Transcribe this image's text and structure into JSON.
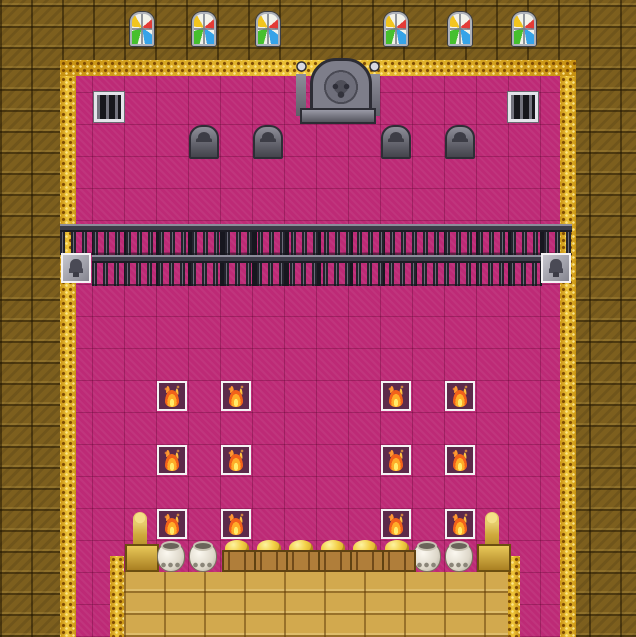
{
  "app": {
    "name": "rpg-map-throne-room",
    "visible_text": []
  },
  "palette": {
    "pink": "#bd2a76",
    "wall": "#7d5f1e",
    "gold": "#e2ae1f",
    "goldfloor": "#d2a94e",
    "white": "#f4f2f4",
    "firedark": "#5c2a4a"
  },
  "map": {
    "tile_size": 32,
    "canvas": {
      "w": 636,
      "h": 637
    },
    "legend": {
      "guard": "silver-helmet guard sprite in white event box",
      "fire": "brazier flame event tile on dark square",
      "sel": "event box highlighted with black border"
    },
    "regions": [
      {
        "t": "room",
        "n": "throne-room-carpet",
        "x": 60,
        "y": 60,
        "w": 516,
        "h": 577,
        "i": false
      },
      {
        "t": "trim",
        "n": "gold-lace-trim-top",
        "x": 60,
        "y": 60,
        "w": 516,
        "h": 16,
        "i": false
      },
      {
        "t": "trim",
        "n": "gold-lace-trim-left",
        "x": 60,
        "y": 76,
        "w": 16,
        "h": 561,
        "i": false
      },
      {
        "t": "trim",
        "n": "gold-lace-trim-right",
        "x": 560,
        "y": 76,
        "w": 16,
        "h": 561,
        "i": false
      },
      {
        "t": "trim",
        "n": "gold-lace-trim-dais-left",
        "x": 110,
        "y": 556,
        "w": 14,
        "h": 81,
        "i": false
      },
      {
        "t": "trim",
        "n": "gold-lace-trim-dais-right",
        "x": 506,
        "y": 556,
        "w": 14,
        "h": 81,
        "i": false
      },
      {
        "t": "goldfloor",
        "n": "gold-brick-dais",
        "x": 124,
        "y": 572,
        "w": 384,
        "h": 65,
        "i": false
      },
      {
        "t": "fence",
        "n": "fence-rail-upper",
        "x": 60,
        "y": 224,
        "w": 512,
        "h": 31,
        "i": false
      },
      {
        "t": "fence",
        "n": "fence-rail-lower",
        "x": 92,
        "y": 255,
        "w": 450,
        "h": 31,
        "i": false
      }
    ],
    "objects": [
      {
        "t": "sgwindow",
        "n": "stained-glass-window",
        "x": 130,
        "y": 12,
        "i": false
      },
      {
        "t": "sgwindow",
        "n": "stained-glass-window",
        "x": 192,
        "y": 12,
        "i": false
      },
      {
        "t": "sgwindow",
        "n": "stained-glass-window",
        "x": 256,
        "y": 12,
        "i": false
      },
      {
        "t": "sgwindow",
        "n": "stained-glass-window",
        "x": 384,
        "y": 12,
        "i": false
      },
      {
        "t": "sgwindow",
        "n": "stained-glass-window",
        "x": 448,
        "y": 12,
        "i": false
      },
      {
        "t": "sgwindow",
        "n": "stained-glass-window",
        "x": 512,
        "y": 12,
        "i": false
      },
      {
        "t": "vent",
        "n": "barred-vent-window",
        "x": 94,
        "y": 92,
        "i": false
      },
      {
        "t": "vent",
        "n": "barred-vent-window",
        "x": 508,
        "y": 92,
        "i": false
      },
      {
        "t": "throne",
        "n": "skull-throne",
        "x": 296,
        "y": 58,
        "i": false
      },
      {
        "t": "tombstone",
        "n": "tombstone",
        "x": 189,
        "y": 125,
        "i": false
      },
      {
        "t": "tombstone",
        "n": "tombstone",
        "x": 253,
        "y": 125,
        "i": false
      },
      {
        "t": "tombstone",
        "n": "tombstone",
        "x": 381,
        "y": 125,
        "i": false
      },
      {
        "t": "tombstone",
        "n": "tombstone",
        "x": 445,
        "y": 125,
        "i": false
      },
      {
        "t": "emblem",
        "n": "crest-emblem",
        "x": 61,
        "y": 253,
        "i": true
      },
      {
        "t": "emblem",
        "n": "crest-emblem",
        "x": 541,
        "y": 253,
        "i": true
      },
      {
        "t": "ent-king",
        "k": "char",
        "n": "king-sprite",
        "x": 189,
        "y": 157,
        "i": true
      },
      {
        "t": "ent-darkknight",
        "k": "char",
        "n": "dark-knight-sprite",
        "x": 253,
        "y": 157,
        "i": true
      },
      {
        "t": "ent-priestess",
        "k": "char",
        "n": "priestess-sprite",
        "x": 381,
        "y": 157,
        "i": true
      },
      {
        "t": "ent-beardknight",
        "k": "char",
        "n": "bearded-warrior-sprite",
        "x": 445,
        "y": 157,
        "i": true
      },
      {
        "t": "ent-butler",
        "k": "char",
        "n": "butler-sprite",
        "x": 317,
        "y": 189,
        "i": true
      },
      {
        "t": "ent-reddress",
        "k": "char",
        "back": true,
        "n": "red-dress-lady-sprite",
        "x": 381,
        "y": 189,
        "i": true
      },
      {
        "t": "ent-guard",
        "k": "char",
        "n": "guard-sprite",
        "x": 61,
        "y": 285,
        "i": true
      },
      {
        "t": "ent-guard",
        "k": "char",
        "n": "guard-sprite",
        "x": 541,
        "y": 285,
        "i": true
      },
      {
        "t": "ent-guard",
        "k": "char",
        "n": "guard-sprite",
        "x": 285,
        "y": 317,
        "i": true
      },
      {
        "t": "ent-guard",
        "k": "char",
        "sel": true,
        "n": "guard-sprite-selected",
        "x": 317,
        "y": 317,
        "i": true
      },
      {
        "t": "ent-guard",
        "k": "char",
        "n": "guard-sprite",
        "x": 349,
        "y": 317,
        "i": true
      },
      {
        "t": "ent-guard",
        "k": "char",
        "n": "guard-sprite",
        "x": 285,
        "y": 349,
        "i": true
      },
      {
        "t": "ent-reddress",
        "k": "char",
        "back": true,
        "n": "red-dress-lady-sprite",
        "x": 317,
        "y": 349,
        "i": true
      },
      {
        "t": "ent-guard",
        "k": "char",
        "n": "guard-sprite",
        "x": 349,
        "y": 349,
        "i": true
      },
      {
        "t": "ent-demon",
        "k": "char",
        "back": true,
        "n": "demon-sprite",
        "x": 413,
        "y": 349,
        "i": true
      },
      {
        "t": "ent-guard",
        "k": "char",
        "n": "guard-sprite",
        "x": 285,
        "y": 381,
        "i": true
      },
      {
        "t": "ent-darkarmor",
        "k": "char",
        "back": true,
        "n": "dark-armor-sprite",
        "x": 317,
        "y": 381,
        "i": true
      },
      {
        "t": "ent-guard",
        "k": "char",
        "n": "guard-sprite",
        "x": 349,
        "y": 381,
        "i": true
      },
      {
        "t": "ent-guard",
        "k": "char",
        "n": "guard-sprite",
        "x": 93,
        "y": 349,
        "i": true
      },
      {
        "t": "ent-guard",
        "k": "char",
        "n": "guard-sprite",
        "x": 93,
        "y": 413,
        "i": true
      },
      {
        "t": "ent-guard",
        "k": "char",
        "n": "guard-sprite",
        "x": 93,
        "y": 477,
        "i": true
      },
      {
        "t": "ent-guard",
        "k": "char",
        "n": "guard-sprite",
        "x": 93,
        "y": 541,
        "i": true
      },
      {
        "t": "ent-guard",
        "k": "char",
        "n": "guard-sprite",
        "x": 509,
        "y": 349,
        "i": true
      },
      {
        "t": "ent-guard",
        "k": "char",
        "n": "guard-sprite",
        "x": 509,
        "y": 413,
        "i": true
      },
      {
        "t": "ent-guard",
        "k": "char",
        "n": "guard-sprite",
        "x": 509,
        "y": 477,
        "i": true
      },
      {
        "t": "ent-guard",
        "k": "char",
        "n": "guard-sprite",
        "x": 509,
        "y": 541,
        "i": true
      },
      {
        "t": "ent-redgirl",
        "k": "char",
        "n": "red-haired-girl-sprite",
        "x": 189,
        "y": 477,
        "i": true
      },
      {
        "t": "fire",
        "n": "brazier-fire",
        "x": 157,
        "y": 381,
        "i": true
      },
      {
        "t": "fire",
        "n": "brazier-fire",
        "x": 221,
        "y": 381,
        "i": true
      },
      {
        "t": "fire",
        "n": "brazier-fire",
        "x": 381,
        "y": 381,
        "i": true
      },
      {
        "t": "fire",
        "n": "brazier-fire",
        "x": 445,
        "y": 381,
        "i": true
      },
      {
        "t": "fire",
        "n": "brazier-fire",
        "x": 157,
        "y": 445,
        "i": true
      },
      {
        "t": "fire",
        "n": "brazier-fire",
        "x": 221,
        "y": 445,
        "i": true
      },
      {
        "t": "fire",
        "n": "brazier-fire",
        "x": 381,
        "y": 445,
        "i": true
      },
      {
        "t": "fire",
        "n": "brazier-fire",
        "x": 445,
        "y": 445,
        "i": true
      },
      {
        "t": "fire",
        "n": "brazier-fire",
        "x": 157,
        "y": 509,
        "i": true
      },
      {
        "t": "fire",
        "n": "brazier-fire",
        "x": 221,
        "y": 509,
        "i": true
      },
      {
        "t": "fire",
        "n": "brazier-fire",
        "x": 381,
        "y": 509,
        "i": true
      },
      {
        "t": "fire",
        "n": "brazier-fire",
        "x": 445,
        "y": 509,
        "i": true
      },
      {
        "t": "statue",
        "n": "gold-statue",
        "x": 125,
        "y": 508,
        "i": true
      },
      {
        "t": "statue",
        "n": "gold-statue",
        "x": 477,
        "y": 508,
        "i": true
      },
      {
        "t": "pot",
        "n": "ceramic-pot",
        "x": 157,
        "y": 542,
        "i": true
      },
      {
        "t": "pot",
        "n": "ceramic-pot",
        "x": 189,
        "y": 542,
        "i": true
      },
      {
        "t": "pot",
        "n": "ceramic-pot",
        "x": 413,
        "y": 542,
        "i": true
      },
      {
        "t": "pot",
        "n": "ceramic-pot",
        "x": 445,
        "y": 542,
        "i": true
      },
      {
        "t": "crate",
        "n": "gold-crate",
        "x": 221,
        "y": 540,
        "i": true
      },
      {
        "t": "crate",
        "n": "gold-crate",
        "x": 253,
        "y": 540,
        "i": true
      },
      {
        "t": "crate",
        "n": "gold-crate",
        "x": 285,
        "y": 540,
        "i": true
      },
      {
        "t": "crate",
        "n": "gold-crate",
        "x": 317,
        "y": 540,
        "i": true
      },
      {
        "t": "crate",
        "n": "gold-crate",
        "x": 349,
        "y": 540,
        "i": true
      },
      {
        "t": "crate",
        "n": "gold-crate",
        "x": 381,
        "y": 540,
        "i": true
      }
    ]
  }
}
